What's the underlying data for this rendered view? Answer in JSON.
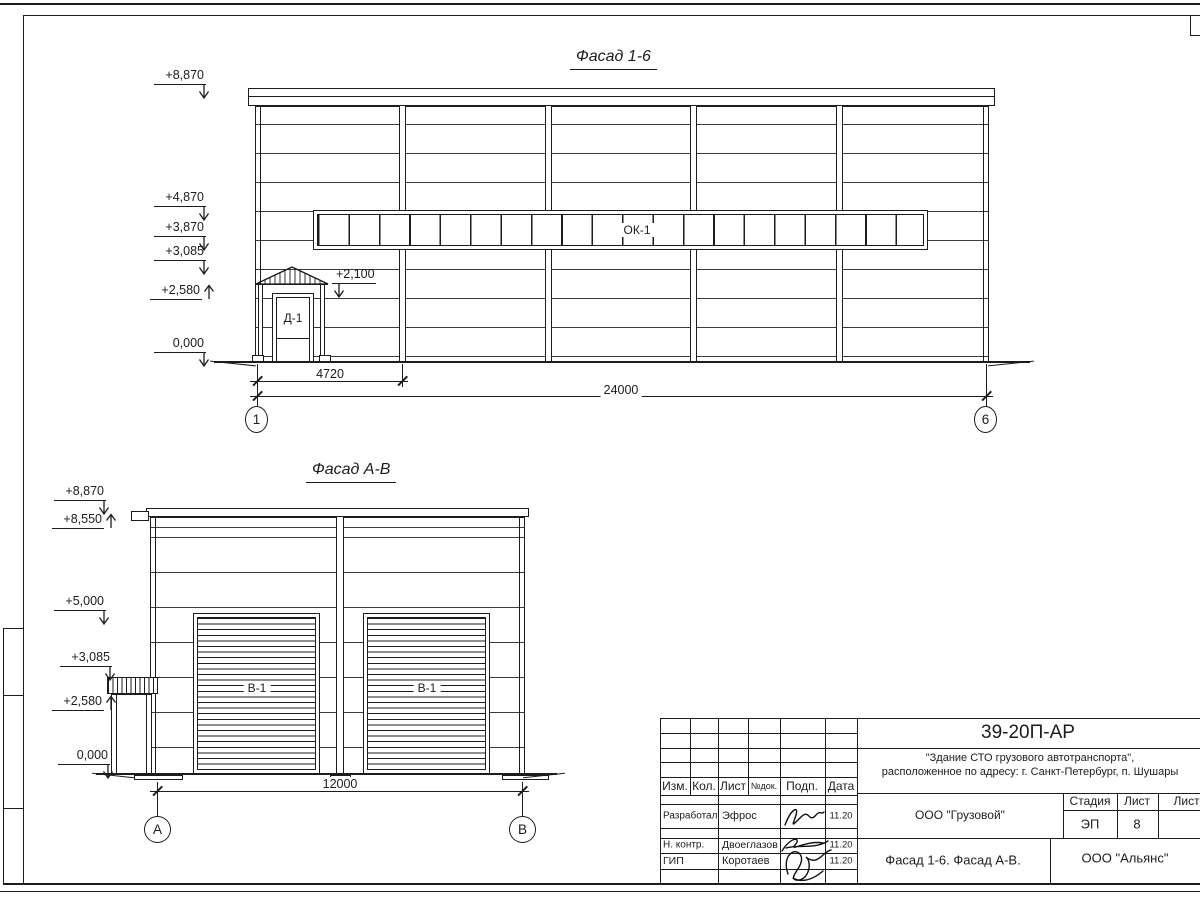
{
  "drawing1": {
    "title": "Фасад 1-6",
    "elevations": [
      "+8,870",
      "+4,870",
      "+3,870",
      "+3,085",
      "+2,580",
      "0,000"
    ],
    "door_elevation": "+2,100",
    "window_band_label": "ОК-1",
    "door_label": "Д-1",
    "dim_first_bay": "4720",
    "dim_total": "24000",
    "axis_start": "1",
    "axis_end": "6"
  },
  "drawing2": {
    "title": "Фасад А-В",
    "elevations": [
      "+8,870",
      "+8,550",
      "+5,000",
      "+3,085",
      "+2,580",
      "0,000"
    ],
    "gate_label": "В-1",
    "dim_total": "12000",
    "axis_start": "А",
    "axis_end": "В"
  },
  "titleblock": {
    "doc_code": "39-20П-АР",
    "project_name_line1": "\"Здание СТО грузового автотранспорта\",",
    "project_name_line2": "расположенное по адресу: г. Санкт-Петербург, п. Шушары",
    "col_izm": "Изм.",
    "col_kol": "Кол.",
    "col_list": "Лист",
    "col_doc": "№док.",
    "col_sign": "Подп.",
    "col_date": "Дата",
    "row_developed_label": "Разработал",
    "row_developed_name": "Эфрос",
    "row_developed_date": "11.20",
    "row_ncontrol_label": "Н. контр.",
    "row_ncontrol_name": "Двоеглазов",
    "row_ncontrol_date": "11.20",
    "row_gip_label": "ГИП",
    "row_gip_name": "Коротаев",
    "row_gip_date": "11.20",
    "customer_org": "ООО \"Грузовой\"",
    "stage_label": "Стадия",
    "sheet_label": "Лист",
    "sheets_label": "Листов",
    "stage_value": "ЭП",
    "sheet_value": "8",
    "drawing_title": "Фасад 1-6. Фасад А-В.",
    "design_org": "ООО \"Альянс\""
  }
}
